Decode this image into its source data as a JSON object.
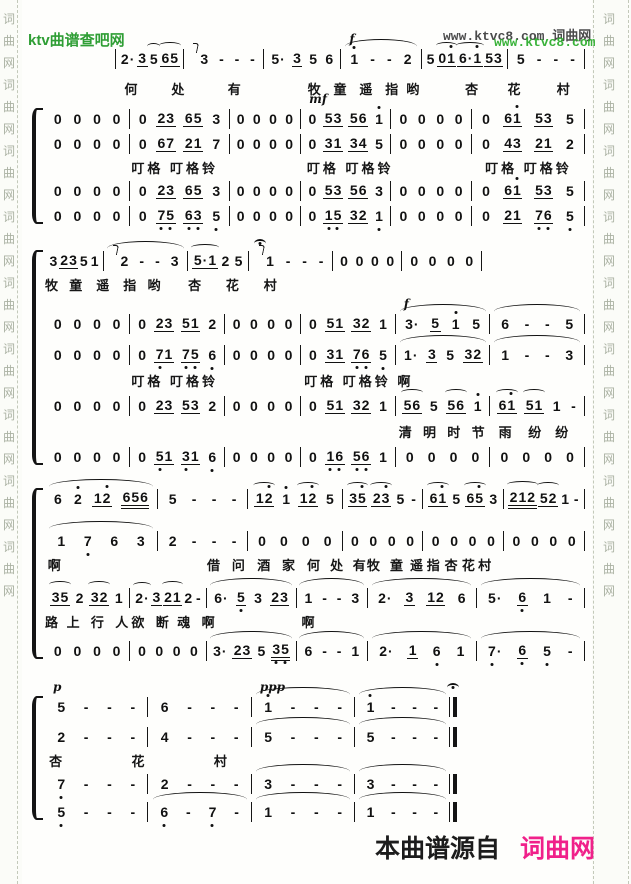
{
  "colors": {
    "site_green": "#2f9e35",
    "watermark_green": "#2fae2f",
    "watermark_gray": "#4b4b4b",
    "brand_pink": "#f0218a",
    "ink": "#111111",
    "strip_char": "#aab1a2"
  },
  "header": {
    "site_name": "ktv曲谱查吧网",
    "watermark_dark": "www.ktvc8.com 词曲网",
    "watermark_green": "www.ktvc8.com"
  },
  "footer": {
    "prefix": "本曲谱源自",
    "brand": "词曲网"
  },
  "border": {
    "chars": [
      "词",
      "曲",
      "网"
    ],
    "repeat": 9
  },
  "score": {
    "systems": [
      {
        "top": 46,
        "left": 115,
        "width": 470,
        "brace": false,
        "startbar": true,
        "rows": [
          {
            "type": "notes",
            "ratios": [
              100,
              120,
              115,
              120,
              130,
              115
            ],
            "measures": [
              "2. 3_ (5 (65_",
              {
                "n": "!3 - - -"
              },
              "5. 3_ 5 6",
              {
                "n": "1' - - 2",
                "d": "f",
                "arc": true
              },
              "5 (01'_ (6.1'_ 53_",
              "5 - - -"
            ]
          },
          {
            "type": "lyrics",
            "mt": 6,
            "items": [
              {
                "t": "何",
                "p": 2
              },
              {
                "t": "处",
                "p": 12
              },
              {
                "t": "有",
                "p": 24
              },
              {
                "t": "牧",
                "p": 41
              },
              {
                "t": "童",
                "p": 46.5
              },
              {
                "t": "遥",
                "p": 52
              },
              {
                "t": "指",
                "p": 57.5
              },
              {
                "t": "哟",
                "p": 62
              },
              {
                "t": "杏",
                "p": 74.5
              },
              {
                "t": "花",
                "p": 83.5
              },
              {
                "t": "村",
                "p": 94
              }
            ]
          }
        ]
      },
      {
        "top": 106,
        "left": 45,
        "width": 540,
        "brace": true,
        "rows": [
          {
            "type": "notes",
            "ratios": [
              85,
              100,
              70,
              90,
              80,
              115
            ],
            "measures": [
              "0 0 0 0",
              "0 23_ 65_ 3",
              "0 0 0 0",
              {
                "n": "0 53_ 56_ 1'",
                "d": "mf"
              },
              "0 0 0 0",
              "0 61'_ 53_ 5"
            ]
          },
          {
            "type": "notes",
            "ratios": [
              85,
              100,
              70,
              90,
              80,
              115
            ],
            "measures": [
              "0 0 0 0",
              "0 67_ 21_ 7",
              "0 0 0 0",
              "0 31_ 34_ 5",
              "0 0 0 0",
              "0 43_ 21_ 2"
            ]
          },
          {
            "type": "lyrics",
            "items": [
              {
                "t": "叮格 叮格铃",
                "p": 16
              },
              {
                "t": "叮格 叮格铃",
                "p": 48.5
              },
              {
                "t": "叮格 叮格铃",
                "p": 81.5
              }
            ]
          },
          {
            "type": "notes",
            "ratios": [
              85,
              100,
              70,
              90,
              80,
              115
            ],
            "measures": [
              "0 0 0 0",
              "0 23_ 65_ 3",
              "0 0 0 0",
              "0 53_ 56_ 3",
              "0 0 0 0",
              "0 61'_ 53_ 5"
            ]
          },
          {
            "type": "notes",
            "ratios": [
              85,
              100,
              70,
              90,
              80,
              115
            ],
            "measures": [
              "0 0 0 0",
              "0 7,5,_ 6,3,_ 5,",
              "0 0 0 0",
              "0 1,5,_ 32_ 1,",
              "0 0 0 0",
              "0 21_ 7,6,_ 5,"
            ]
          }
        ]
      },
      {
        "top": 248,
        "left": 45,
        "width": 540,
        "brace": true,
        "rows": [
          {
            "type": "notes",
            "w": 81,
            "ratios": [
              65,
              100,
              70,
              100,
              80,
              95
            ],
            "measures": [
              "3 23_ 5 1",
              {
                "n": "!2 - - 3",
                "arc": true
              },
              "(5.1_ 2 5",
              {
                "n": "!^1 - - -"
              },
              "0 0 0 0",
              "0 0 0 0"
            ]
          },
          {
            "type": "lyrics",
            "items": [
              {
                "t": "牧",
                "p": 0
              },
              {
                "t": "童",
                "p": 4.5
              },
              {
                "t": "遥",
                "p": 9.5
              },
              {
                "t": "指",
                "p": 14.5
              },
              {
                "t": "哟",
                "p": 19
              },
              {
                "t": "杏",
                "p": 26.5
              },
              {
                "t": "花",
                "p": 33.5
              },
              {
                "t": "村",
                "p": 40.5
              }
            ]
          },
          {
            "type": "notes",
            "mt": 16,
            "ratios": [
              85,
              95,
              75,
              95,
              95,
              95
            ],
            "measures": [
              "0 0 0 0",
              "0 23_ 51_ 2",
              "0 0 0 0",
              "0 51_ 32_ 1",
              {
                "n": "3. 5_ 1' 5",
                "d": "f",
                "arc": true
              },
              {
                "n": "6 - - 5",
                "arc": true
              }
            ]
          },
          {
            "type": "notes",
            "mt": 6,
            "ratios": [
              85,
              95,
              75,
              95,
              95,
              95
            ],
            "measures": [
              "0 0 0 0",
              "0 7,1_ 7,5,_ 6,",
              "0 0 0 0",
              "0 31_ 7,6,_ 5,",
              {
                "n": "1. 3_ 5 32_",
                "arc": true
              },
              {
                "n": "1 - - 3",
                "arc": true
              }
            ]
          },
          {
            "type": "lyrics",
            "mt": 2,
            "items": [
              {
                "t": "叮格 叮格铃",
                "p": 16
              },
              {
                "t": "叮格 叮格铃 啊",
                "p": 48
              }
            ]
          },
          {
            "type": "notes",
            "mt": 2,
            "ratios": [
              85,
              95,
              75,
              95,
              95,
              95
            ],
            "measures": [
              "0 0 0 0",
              "0 23_ 53_ 2",
              "0 0 0 0",
              "0 51_ 32_ 1",
              "(56_ 5 (56_ 1'",
              "(61'_ (51_ 1 -"
            ]
          },
          {
            "type": "lyrics",
            "mt": 2,
            "items": [
              {
                "t": "清",
                "p": 65.5
              },
              {
                "t": "明",
                "p": 70
              },
              {
                "t": "时",
                "p": 74.5
              },
              {
                "t": "节",
                "p": 79
              },
              {
                "t": "雨",
                "p": 84
              },
              {
                "t": "纷",
                "p": 89.5
              },
              {
                "t": "纷",
                "p": 94.5
              }
            ]
          },
          {
            "type": "notes",
            "mt": 2,
            "ratios": [
              85,
              95,
              75,
              95,
              95,
              95
            ],
            "measures": [
              "0 0 0 0",
              "0 5,1_ 3,1_ 6,",
              "0 0 0 0",
              "0 1,6,_ 5,6,_ 1",
              "0 0 0 0",
              "0 0 0 0"
            ]
          }
        ]
      },
      {
        "top": 486,
        "left": 45,
        "width": 540,
        "brace": true,
        "rows": [
          {
            "type": "notes",
            "ratios": [
              115,
              90,
              95,
              80,
              80,
              80
            ],
            "measures": [
              {
                "n": "6 2' 12'_ 656=",
                "arc": true
              },
              "5 - - -",
              "(12'_ 1' (12'_ 5",
              "(35'_ (23'_ 5 -",
              "(61'_ 5 (65'_ 3",
              "(212= (52_ 1 -"
            ]
          },
          {
            "type": "notes",
            "mt": 17,
            "ratios": [
              115,
              90,
              95,
              80,
              80,
              80
            ],
            "measures": [
              {
                "n": "1 7, 6 3",
                "arc": true
              },
              "2 - - -",
              "0 0 0 0",
              "0 0 0 0",
              "0 0 0 0",
              "0 0 0 0"
            ]
          },
          {
            "type": "lyrics",
            "items": [
              {
                "t": "啊",
                "p": 0.5
              },
              {
                "t": "借",
                "p": 30
              },
              {
                "t": "问",
                "p": 34.6
              },
              {
                "t": "酒",
                "p": 39.3
              },
              {
                "t": "家",
                "p": 43.9
              },
              {
                "t": "何",
                "p": 48.5
              },
              {
                "t": "处",
                "p": 52.8
              },
              {
                "t": "有",
                "p": 57
              },
              {
                "t": "牧",
                "p": 59.6
              },
              {
                "t": "童",
                "p": 63.9
              },
              {
                "t": "遥",
                "p": 67.6
              },
              {
                "t": "指",
                "p": 70.7
              },
              {
                "t": "杏",
                "p": 74
              },
              {
                "t": "花",
                "p": 77.2
              },
              {
                "t": "村",
                "p": 80.2
              }
            ]
          },
          {
            "type": "notes",
            "mt": 10,
            "ratios": [
              85,
              75,
              90,
              70,
              110,
              110
            ],
            "measures": [
              "(35_ 2 (32_ 1",
              "(2. 3_ (21_ 2 -",
              {
                "n": "6. 5,_ 3 23_",
                "arc": true
              },
              {
                "n": "1 - - 3",
                "arc": true
              },
              {
                "n": "2. 3_ 12_ 6",
                "arc": true
              },
              {
                "n": "5. 6,_ 1 -",
                "arc": true
              }
            ]
          },
          {
            "type": "lyrics",
            "items": [
              {
                "t": "路",
                "p": 0
              },
              {
                "t": "上",
                "p": 4
              },
              {
                "t": "行",
                "p": 8.5
              },
              {
                "t": "人",
                "p": 13
              },
              {
                "t": "欲",
                "p": 16
              },
              {
                "t": "断",
                "p": 20.5
              },
              {
                "t": "魂",
                "p": 24.5
              },
              {
                "t": "啊",
                "p": 29
              },
              {
                "t": "啊",
                "p": 47.5
              }
            ]
          },
          {
            "type": "notes",
            "mt": 6,
            "ratios": [
              85,
              75,
              90,
              70,
              110,
              110
            ],
            "measures": [
              "0 0 0 0",
              "0 0 0 0",
              {
                "n": "3. 23_ 5 3,5,=",
                "arc": true
              },
              {
                "n": "6 - - 1",
                "arc": true
              },
              {
                "n": "2. 1_ 6, 1",
                "arc": true
              },
              {
                "n": "7,. 6,_ 5, -",
                "arc": true
              }
            ]
          }
        ]
      },
      {
        "top": 694,
        "left": 45,
        "width": 412,
        "brace": true,
        "rows": [
          {
            "type": "notes",
            "end": "double",
            "ferm": true,
            "ratios": [
              105,
              105,
              105,
              96
            ],
            "measures": [
              {
                "n": "5 - - -",
                "d": "p"
              },
              "6 - - -",
              {
                "n": "1' - - -",
                "d": "ppp",
                "arc": true
              },
              {
                "n": "1' - - -",
                "arc": true
              }
            ]
          },
          {
            "type": "notes",
            "mt": 5,
            "end": "double",
            "ratios": [
              105,
              105,
              105,
              96
            ],
            "measures": [
              "2 - - -",
              "4 - - -",
              {
                "n": "5 - - -",
                "arc": true
              },
              {
                "n": "5 - - -",
                "arc": true
              }
            ]
          },
          {
            "type": "lyrics",
            "items": [
              {
                "t": "杏",
                "p": 1
              },
              {
                "t": "花",
                "p": 21
              },
              {
                "t": "村",
                "p": 41
              }
            ]
          },
          {
            "type": "notes",
            "end": "double",
            "ratios": [
              105,
              105,
              105,
              96
            ],
            "measures": [
              "7, - - -",
              "2 - - -",
              {
                "n": "3 - - -",
                "arc": true
              },
              {
                "n": "3 - - -",
                "arc": true
              }
            ]
          },
          {
            "type": "notes",
            "mt": 3,
            "end": "double",
            "ratios": [
              105,
              105,
              105,
              96
            ],
            "measures": [
              "5, - - -",
              {
                "n": "6, - 7, -",
                "arc": true
              },
              {
                "n": "1 - - -",
                "arc": true
              },
              {
                "n": "1 - - -",
                "arc": true
              }
            ]
          }
        ]
      }
    ]
  }
}
